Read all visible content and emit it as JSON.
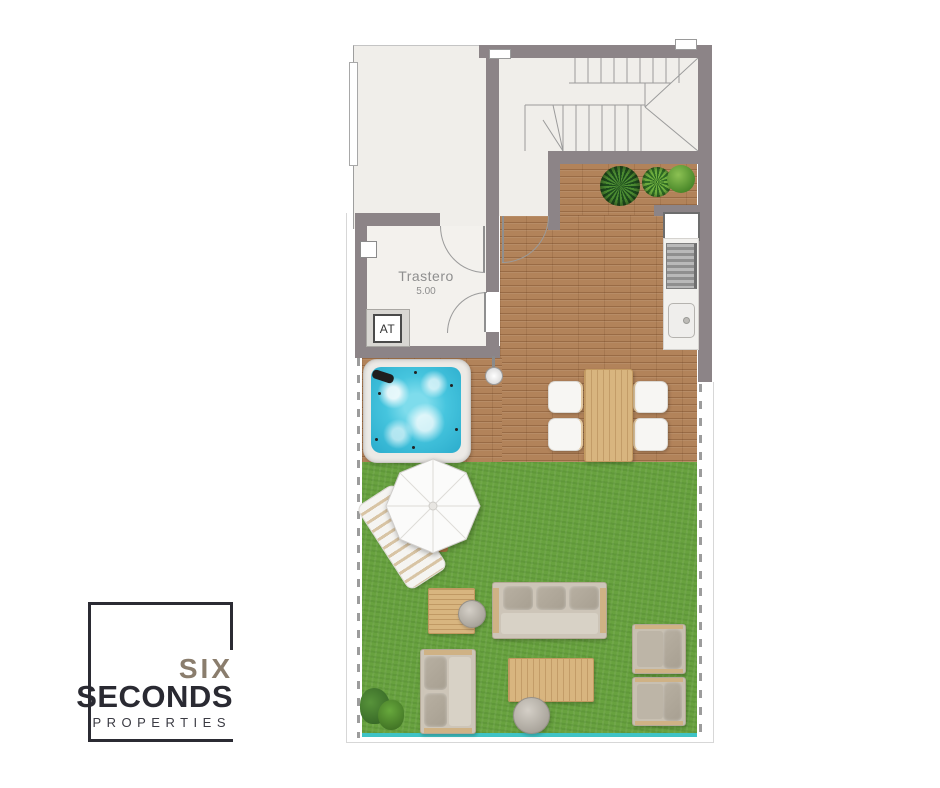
{
  "meta": {
    "type": "floor-plan",
    "description": "Top-down apartment floor plan with storage room, staircase, wooden terrace, jacuzzi, outdoor kitchen, dining set and garden lounge furniture"
  },
  "plan": {
    "rooms": [
      {
        "name": "storage",
        "label": "Trastero",
        "area_label": "5.00"
      }
    ],
    "labels": {
      "utility": "AT"
    },
    "features": [
      "staircase",
      "jacuzzi",
      "outdoor-shower",
      "kitchen-counter",
      "grill",
      "sink",
      "window",
      "dining-table",
      "chairs",
      "parasol",
      "sun-lounger",
      "three-seat-sofa",
      "two-seat-sofa",
      "armchairs",
      "coffee-table",
      "side-table",
      "stone-tables",
      "potted-plants",
      "bush",
      "lawn",
      "wood-deck",
      "property-boundary-dashed",
      "pool-edge"
    ],
    "colors": {
      "wall": "#8c8487",
      "interior_floor": "#f0eeea",
      "wood_deck": "#b2835a",
      "light_wood": "#d8b57f",
      "grass": "#68a23f",
      "water": "#3fc0da",
      "pool_edge_teal": "#3fc3c5"
    }
  },
  "logo": {
    "word1": "SIX",
    "word2": "SECONDS",
    "word3": "PROPERTIES",
    "frame_color": "#2b2b33",
    "word1_color": "#8a7d6d",
    "word2_color": "#2a2a32",
    "word3_color": "#3b3b43"
  }
}
